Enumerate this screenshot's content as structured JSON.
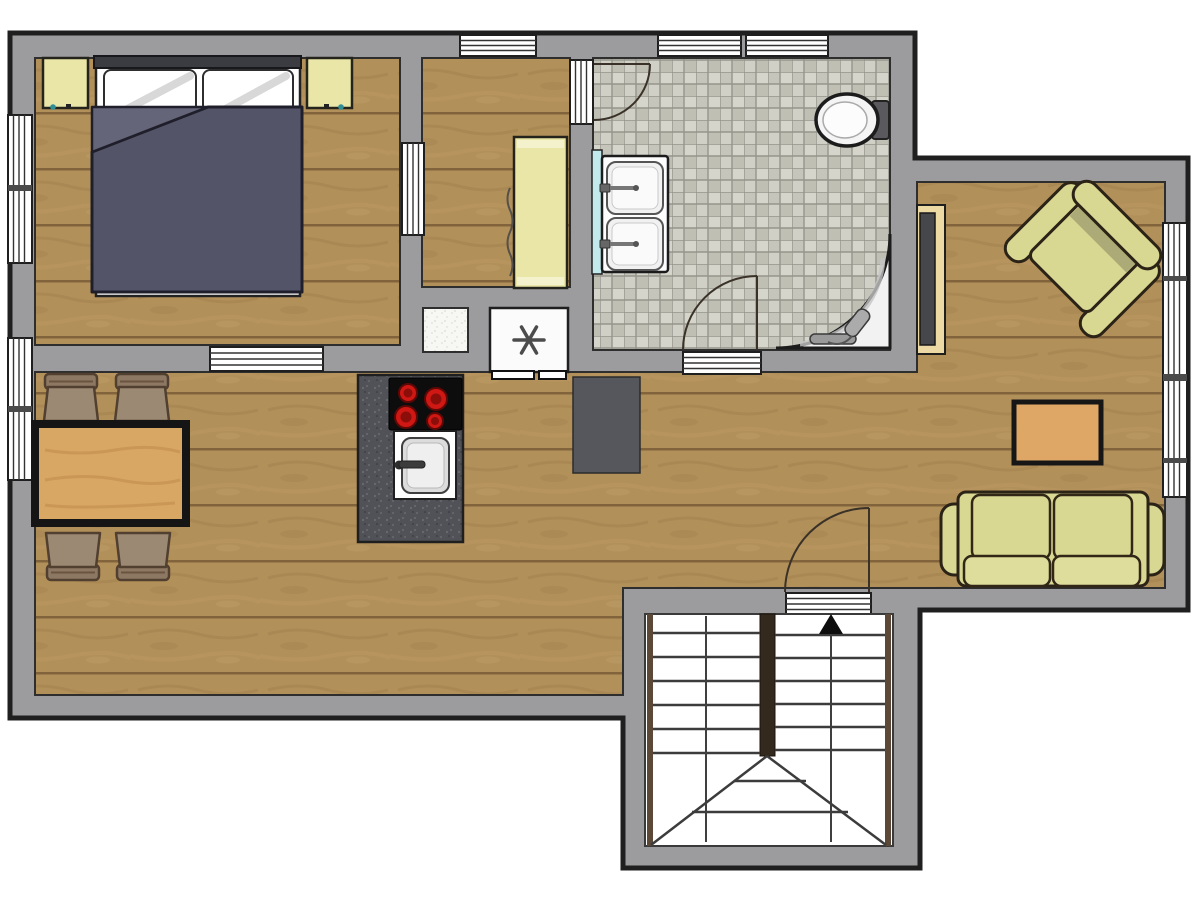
{
  "meta": {
    "title": "apartment-floor-plan",
    "type": "architectural-floor-plan",
    "visible_text": "none — plan uses symbols only",
    "symbols": {
      "freezer_star": "✱",
      "stairs_direction": "▲ up"
    }
  },
  "colors": {
    "outside": "#ffffff",
    "wall": "#9c9c9e",
    "outline": "#1f1f1f",
    "wood_floor_base": "#b2905a",
    "tile_floor_base": "#ccccc3",
    "furniture_green": "#d9d893",
    "furniture_green_shade": "#a3a272",
    "duvet": "#545468",
    "duvet_fold": "#656579",
    "pillow": "#ffffff",
    "headboard": "#3b3b42",
    "cabinet_yellow": "#e9e6a8",
    "table_wood": "#d8a763",
    "coffee_table_wood": "#dfa765",
    "chair_brown": "#9b8974",
    "island_dark": "#515257",
    "cooktop_black": "#0d0d0d",
    "burner_red": "#cf1713",
    "counter_dark": "#55575c",
    "appliance_white": "#fbfbfb",
    "vanity_cyan": "#c2e9ec",
    "fixture_white": "#f2f2f2",
    "stair_stringer": "#5b4836",
    "door_arc": "#3a3228"
  },
  "rooms": [
    {
      "name": "bedroom",
      "furniture": [
        "double-bed",
        "nightstand-left",
        "nightstand-right"
      ]
    },
    {
      "name": "hallway-closet",
      "furniture": [
        "wardrobe"
      ]
    },
    {
      "name": "bathroom",
      "furniture": [
        "toilet",
        "double-sink-vanity",
        "corner-shower"
      ]
    },
    {
      "name": "open-living-dining-kitchen",
      "furniture": [
        "dining-table",
        "dining-chairs-x4",
        "kitchen-island-cooktop-sink",
        "freezer",
        "white-cabinet",
        "dark-counter",
        "tv-board",
        "armchair",
        "coffee-table",
        "sofa"
      ]
    },
    {
      "name": "stairwell",
      "furniture": [
        "u-shaped-staircase"
      ]
    }
  ],
  "openings": {
    "windows_top": 3,
    "windows_left": 2,
    "windows_right": 1,
    "door_thresholds": 5,
    "door_swings": 3
  }
}
